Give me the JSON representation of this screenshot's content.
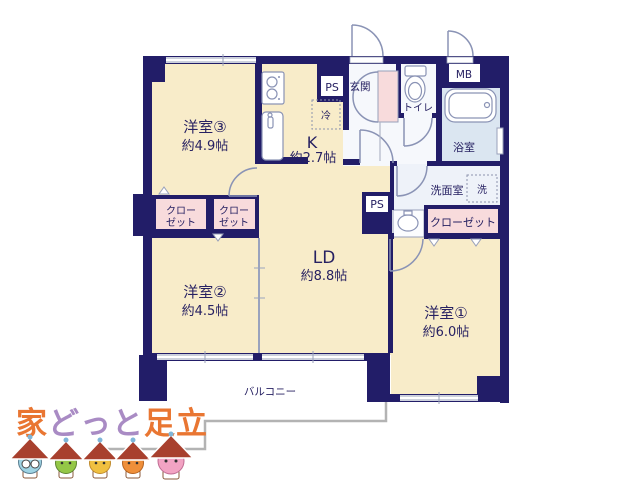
{
  "plan": {
    "rooms": {
      "room3": {
        "name": "洋室③",
        "size": "約4.9帖"
      },
      "kitchen": {
        "name": "K",
        "size": "約2.7帖"
      },
      "ld": {
        "name": "LD",
        "size": "約8.8帖"
      },
      "room2": {
        "name": "洋室②",
        "size": "約4.5帖"
      },
      "room1": {
        "name": "洋室①",
        "size": "約6.0帖"
      }
    },
    "labels": {
      "entrance": "玄関",
      "toilet": "トイレ",
      "meter_box": "MB",
      "bathroom": "浴室",
      "washroom": "洗面室",
      "washer": "洗",
      "refrigerator": "冷",
      "pipe_space": "PS",
      "closet_line1": "クロー",
      "closet_line2": "ゼット",
      "closet": "クローゼット",
      "balcony": "バルコニー"
    }
  },
  "logo": {
    "part1": "家",
    "part2": "どっと",
    "part3": "足立"
  },
  "colors": {
    "wall_navy": "#221d68",
    "room_cream": "#f8ecc9",
    "closet_pink": "#f8dbdc",
    "bath_blue": "#dbe6f1",
    "washroom_blue": "#eef2f9",
    "hall_white": "#f6f8fc",
    "line_gray": "#98a0ba",
    "fence_gray": "#b3b3b3",
    "logo_orange": "#e97632",
    "logo_purple": "#a98bc4",
    "mascot_roof": "#a8402e"
  }
}
